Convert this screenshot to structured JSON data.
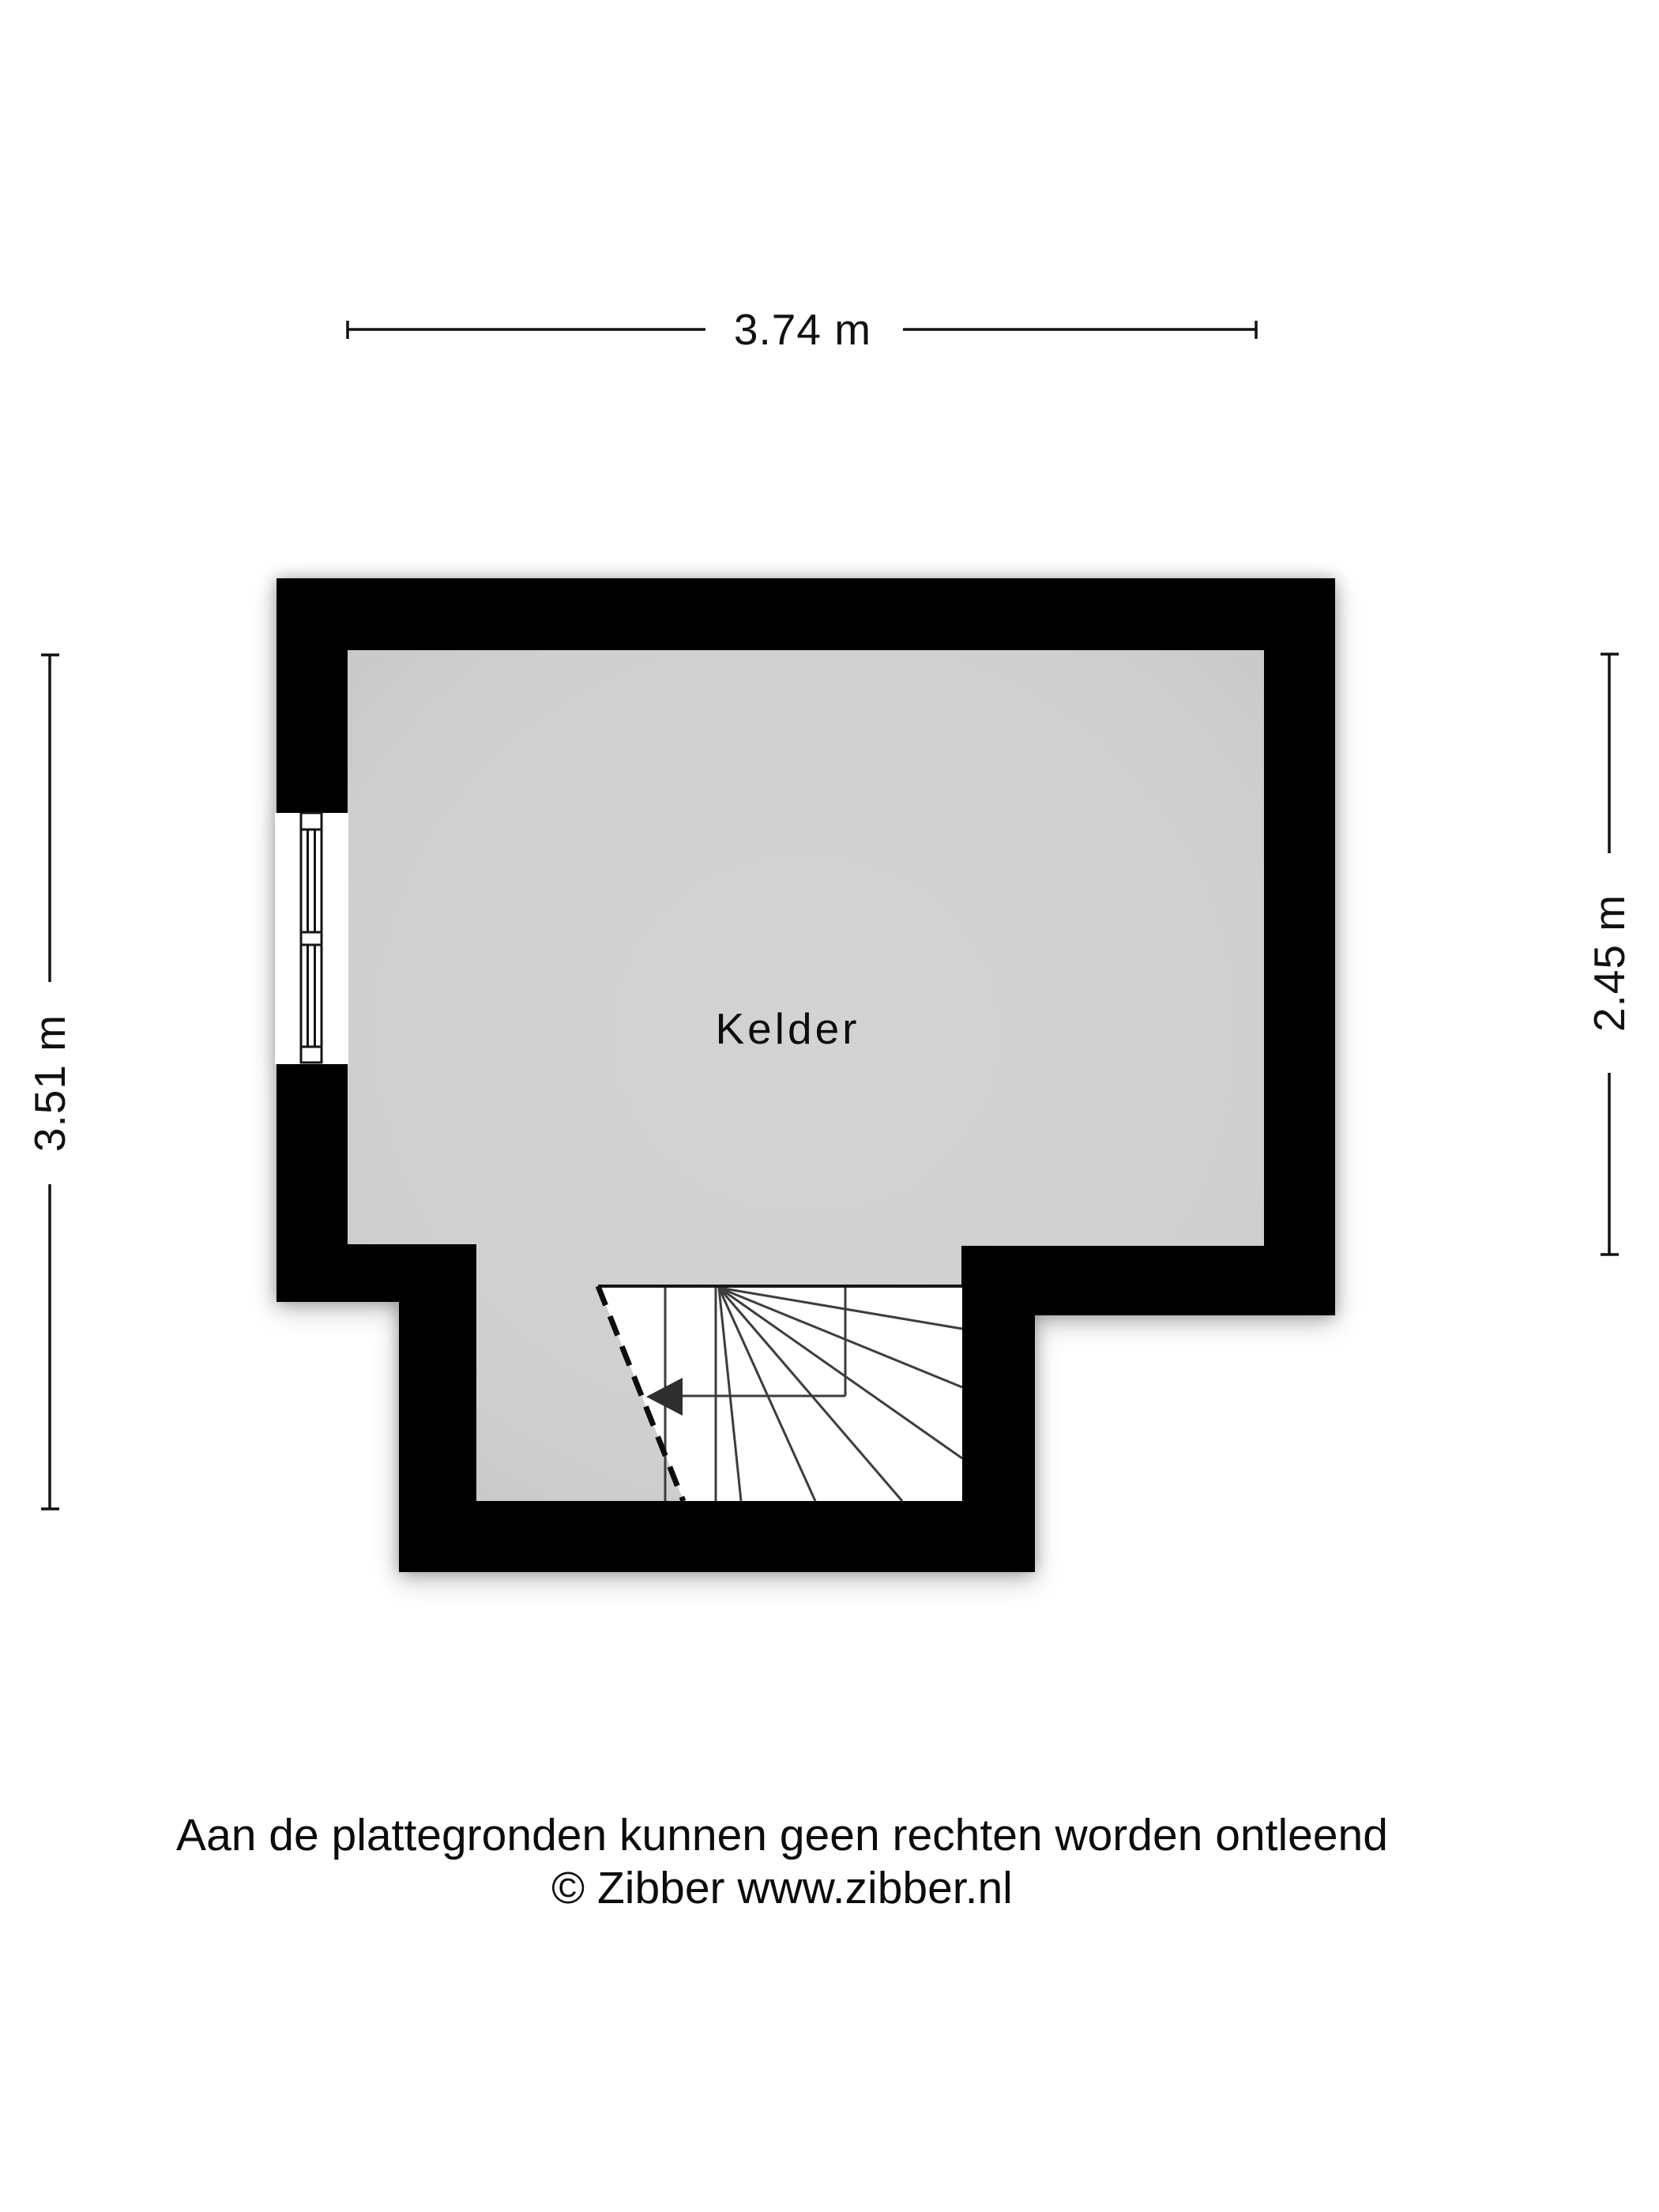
{
  "room": {
    "label": "Kelder"
  },
  "dimensions": {
    "width_top": "3.74 m",
    "height_left": "3.51 m",
    "height_right": "2.45 m"
  },
  "footer": {
    "disclaimer": "Aan de plattegronden kunnen geen rechten worden ontleend",
    "credit": "© Zibber www.zibber.nl"
  },
  "icons": {
    "stairs_arrow": "stairs-direction-arrow"
  },
  "colors": {
    "wall": "#000000",
    "floor": "#d0d0d0",
    "stairs_background": "#ffffff",
    "stair_line": "#3d3d3d",
    "text": "#111111",
    "background": "#ffffff"
  }
}
